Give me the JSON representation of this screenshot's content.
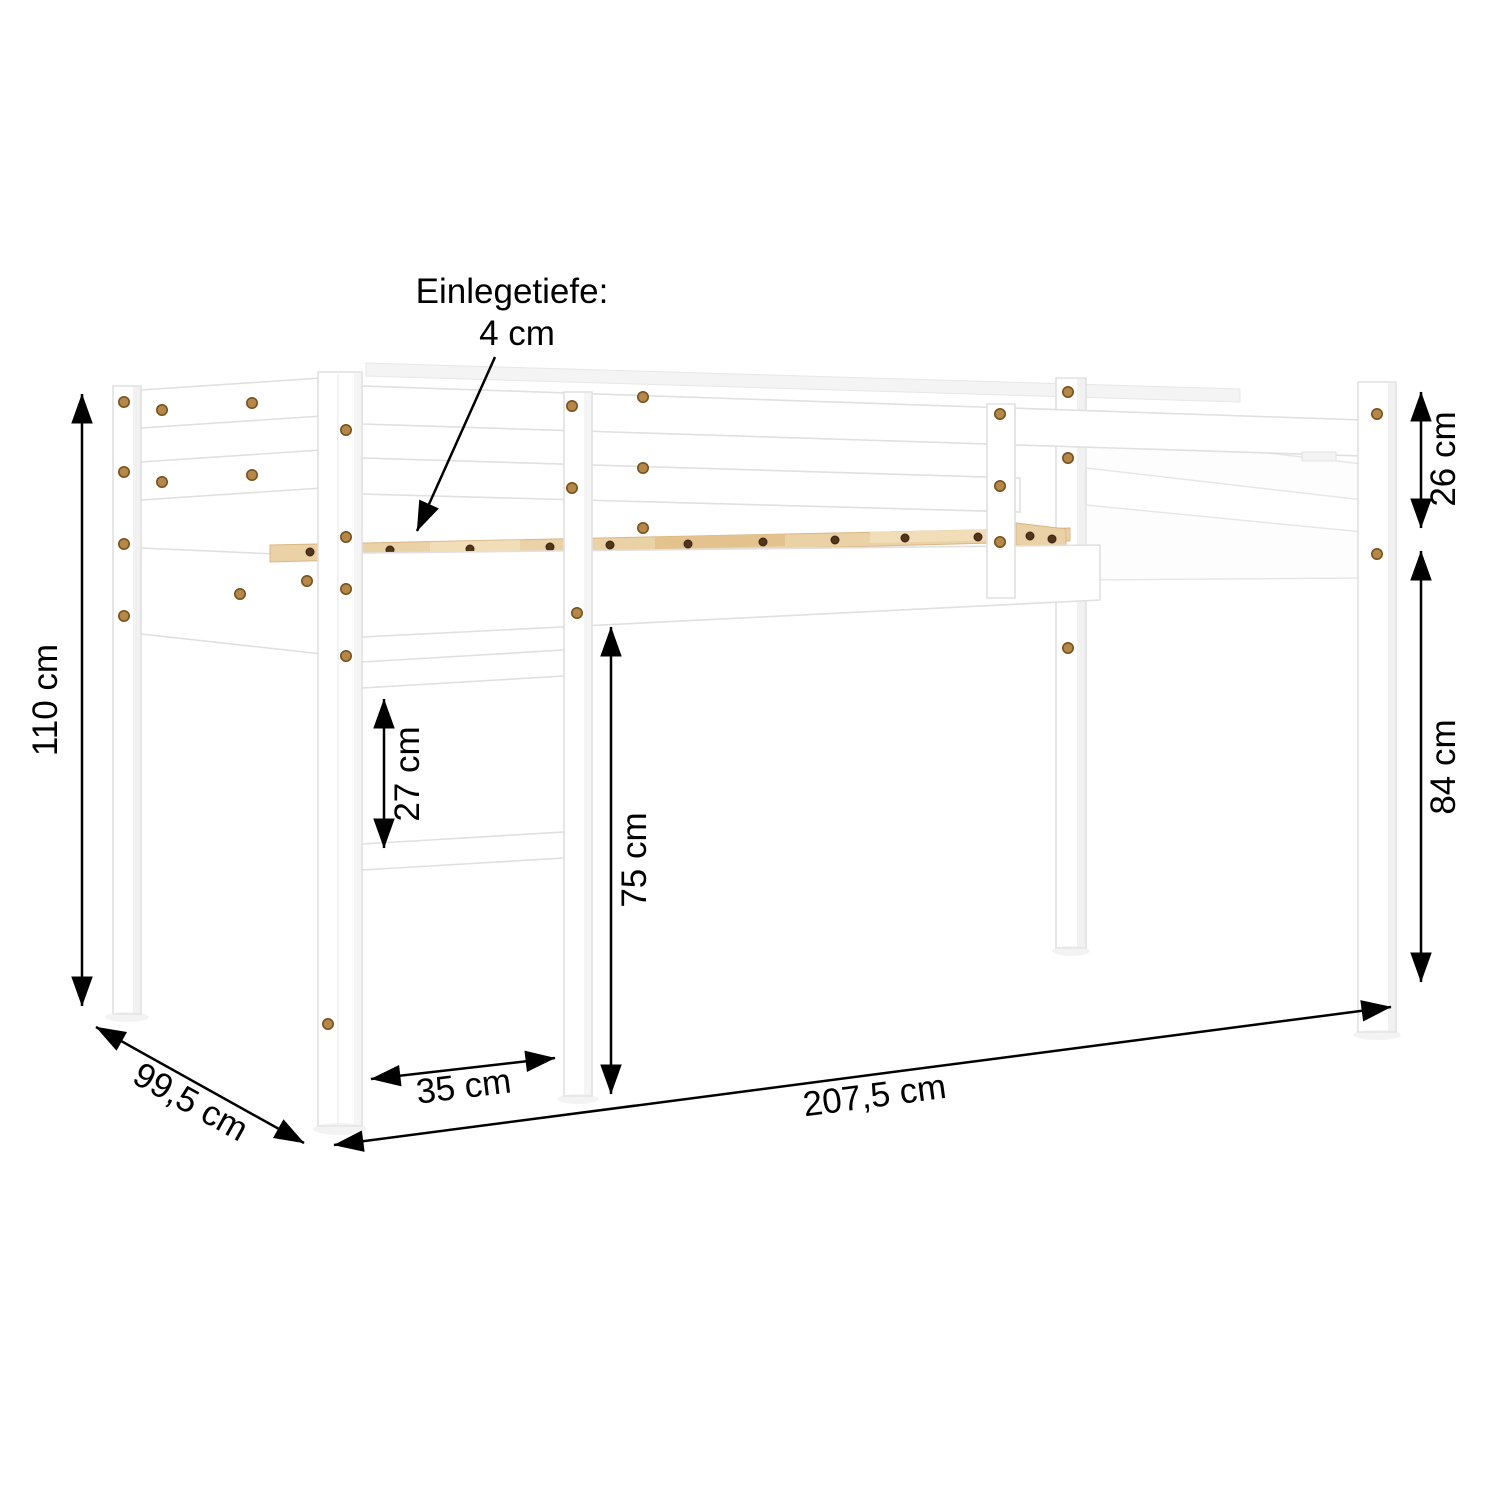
{
  "diagram": {
    "callout": {
      "line1": "Einlegetiefe:",
      "line2": "4 cm"
    },
    "dimensions": {
      "total_height": {
        "label": "110 cm"
      },
      "depth": {
        "label": "99,5 cm"
      },
      "length": {
        "label": "207,5 cm"
      },
      "ladder_width": {
        "label": "35 cm"
      },
      "under_bed_clearance": {
        "label": "75 cm"
      },
      "rung_spacing": {
        "label": "27 cm"
      },
      "guardrail_height": {
        "label": "26 cm"
      },
      "floor_to_frame": {
        "label": "84 cm"
      }
    },
    "colors": {
      "background": "#ffffff",
      "annotation": "#000000",
      "frame": "#ffffff",
      "frame_edge": "#e0e0e0",
      "slat_wood": "#ebd1a6",
      "screw_brass": "#b5884a"
    }
  }
}
